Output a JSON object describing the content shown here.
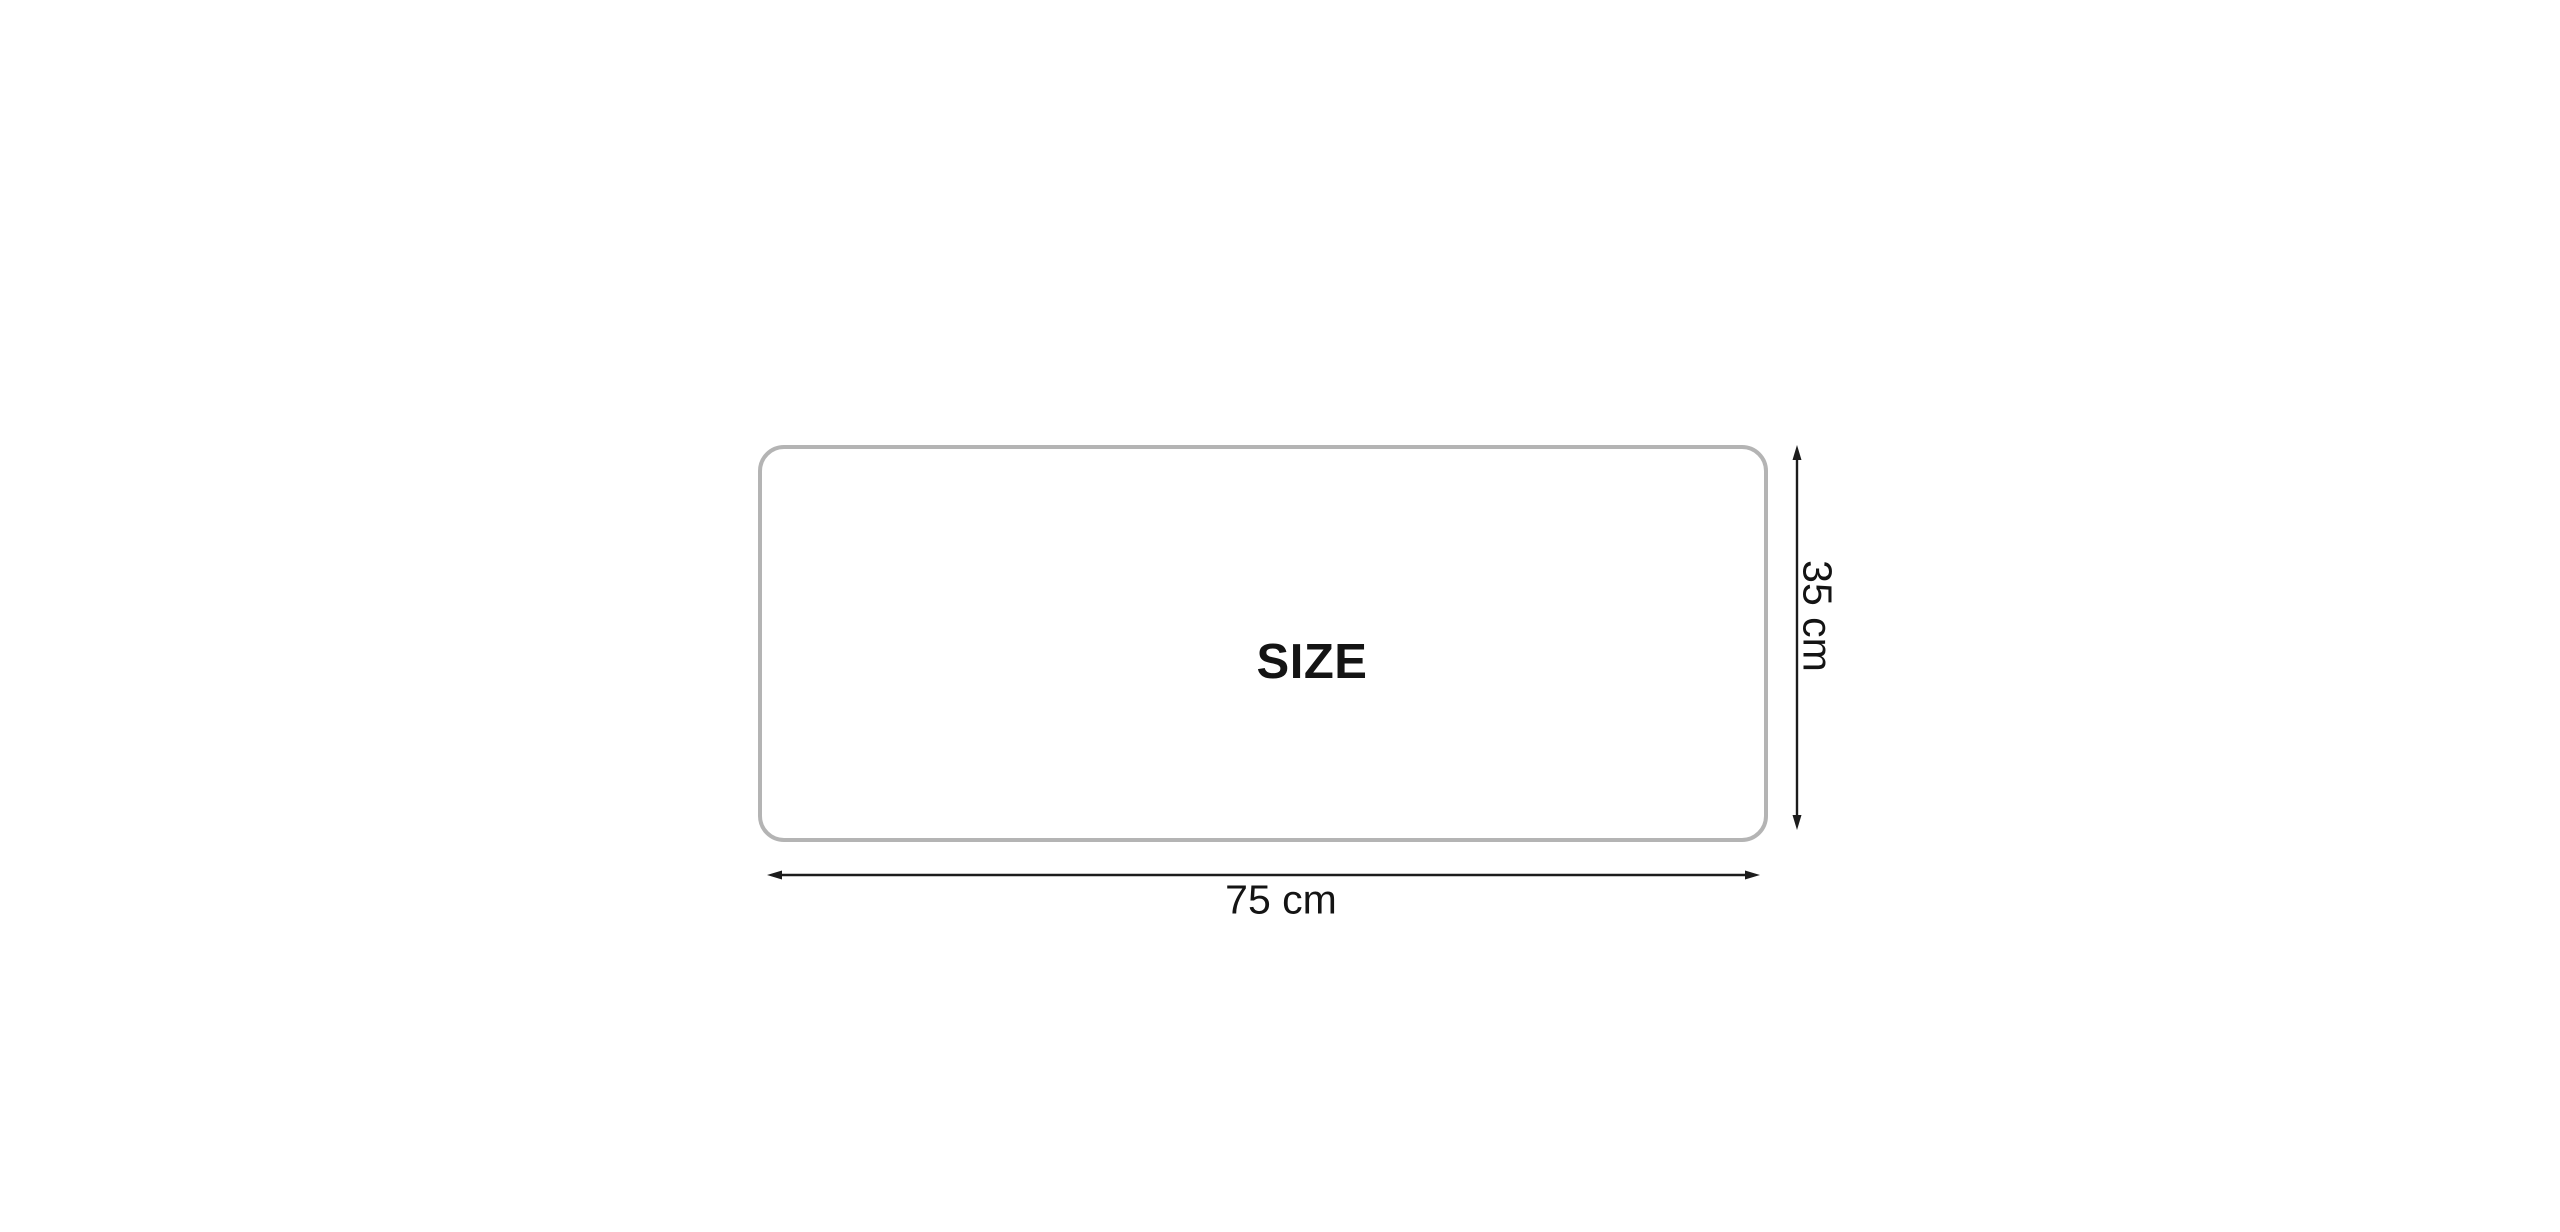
{
  "colors": {
    "background": "#ffffff",
    "rect_border": "#b4b4b4",
    "dimension_line": "#1c1c1c",
    "label_text": "#141414"
  },
  "diagram": {
    "size_label": "SIZE",
    "width_dimension": "75 cm",
    "height_dimension": "35 cm"
  }
}
